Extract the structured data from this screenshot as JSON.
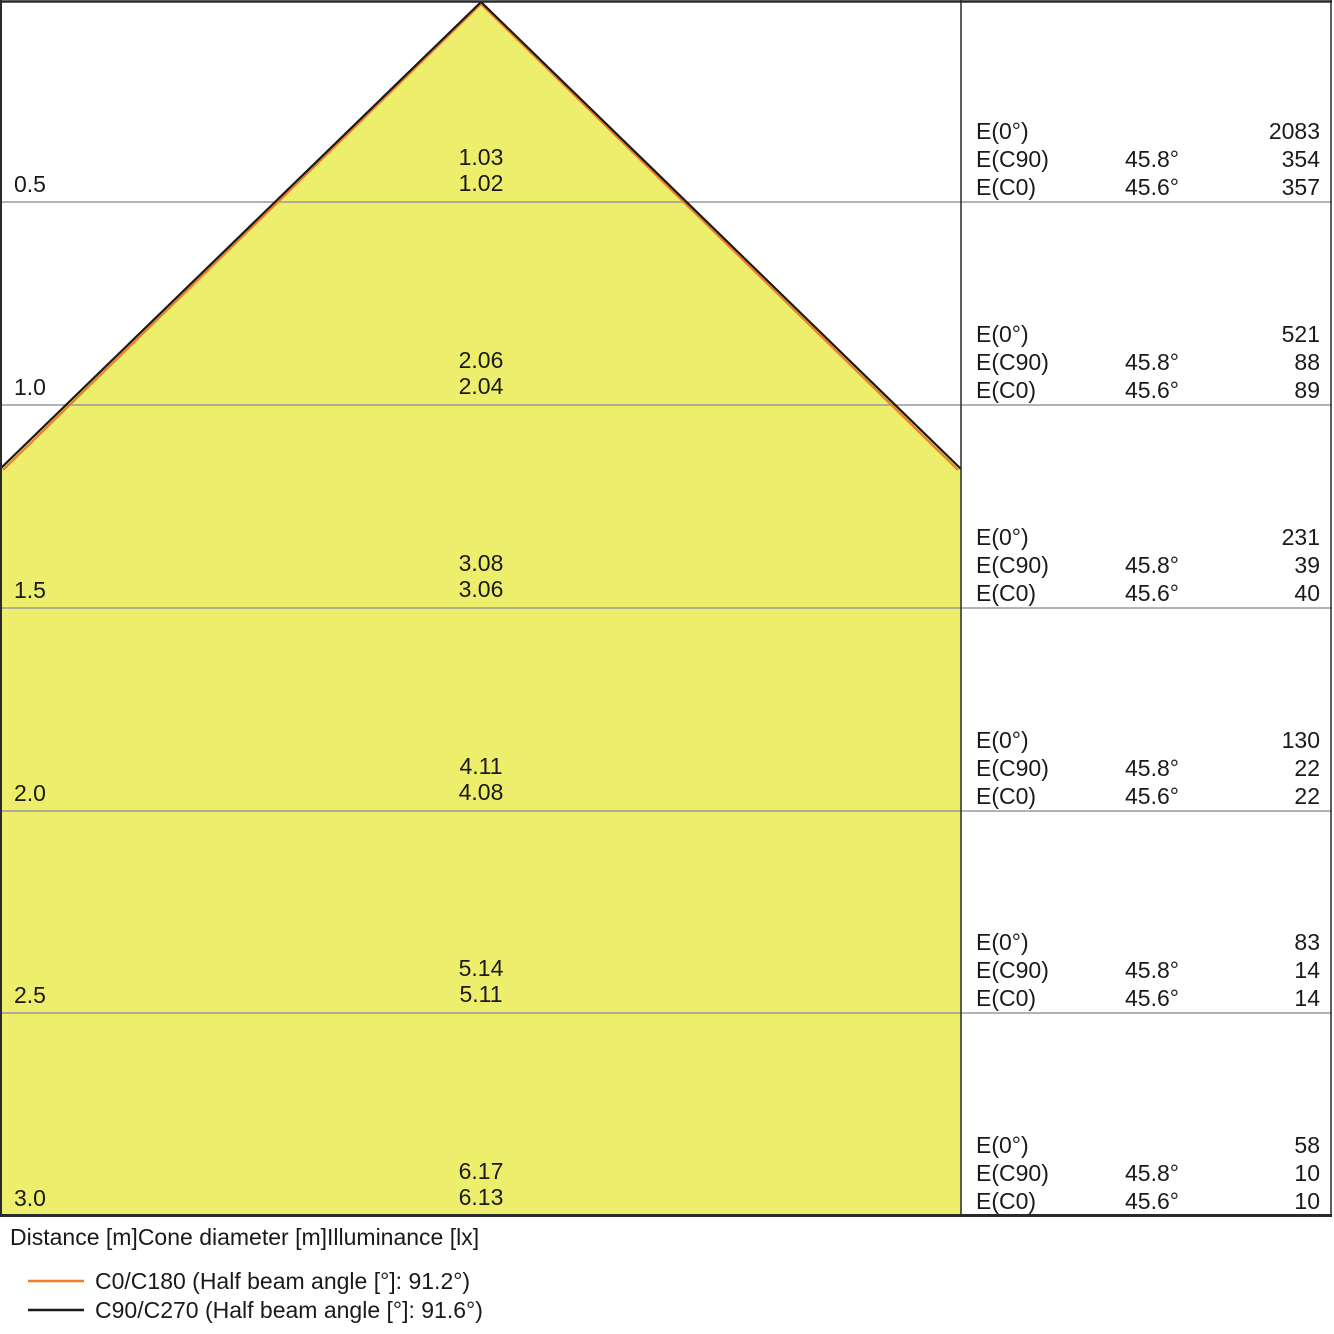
{
  "caption": "Distance [m]Cone diameter [m]Illuminance [lx]",
  "colors": {
    "cone_fill": "#edee6b",
    "c0_line": "#ef7d28",
    "c90_line": "#1a1a1a",
    "grid_line": "#9a9a9a",
    "border": "#2a2a2a"
  },
  "legend": {
    "c0": {
      "label": "C0/C180 (Half beam angle [°]: 91.2°)"
    },
    "c90": {
      "label": "C90/C270 (Half beam angle [°]: 91.6°)"
    }
  },
  "rows": [
    {
      "distance": "0.5",
      "dia_c90": "1.03",
      "dia_c0": "1.02",
      "e0_label": "E(0°)",
      "e0": "2083",
      "ec90_label": "E(C90)",
      "ec90_angle": "45.8°",
      "ec90": "354",
      "ec0_label": "E(C0)",
      "ec0_angle": "45.6°",
      "ec0": "357"
    },
    {
      "distance": "1.0",
      "dia_c90": "2.06",
      "dia_c0": "2.04",
      "e0_label": "E(0°)",
      "e0": "521",
      "ec90_label": "E(C90)",
      "ec90_angle": "45.8°",
      "ec90": "88",
      "ec0_label": "E(C0)",
      "ec0_angle": "45.6°",
      "ec0": "89"
    },
    {
      "distance": "1.5",
      "dia_c90": "3.08",
      "dia_c0": "3.06",
      "e0_label": "E(0°)",
      "e0": "231",
      "ec90_label": "E(C90)",
      "ec90_angle": "45.8°",
      "ec90": "39",
      "ec0_label": "E(C0)",
      "ec0_angle": "45.6°",
      "ec0": "40"
    },
    {
      "distance": "2.0",
      "dia_c90": "4.11",
      "dia_c0": "4.08",
      "e0_label": "E(0°)",
      "e0": "130",
      "ec90_label": "E(C90)",
      "ec90_angle": "45.8°",
      "ec90": "22",
      "ec0_label": "E(C0)",
      "ec0_angle": "45.6°",
      "ec0": "22"
    },
    {
      "distance": "2.5",
      "dia_c90": "5.14",
      "dia_c0": "5.11",
      "e0_label": "E(0°)",
      "e0": "83",
      "ec90_label": "E(C90)",
      "ec90_angle": "45.8°",
      "ec90": "14",
      "ec0_label": "E(C0)",
      "ec0_angle": "45.6°",
      "ec0": "14"
    },
    {
      "distance": "3.0",
      "dia_c90": "6.17",
      "dia_c0": "6.13",
      "e0_label": "E(0°)",
      "e0": "58",
      "ec90_label": "E(C90)",
      "ec90_angle": "45.8°",
      "ec90": "10",
      "ec0_label": "E(C0)",
      "ec0_angle": "45.6°",
      "ec0": "10"
    }
  ],
  "chart_data": {
    "type": "area",
    "title": "Luminous cone diagram (distance vs. cone diameter vs. illuminance)",
    "xlabel": "Cone diameter [m]",
    "ylabel": "Distance [m]",
    "categories": [
      0.5,
      1.0,
      1.5,
      2.0,
      2.5,
      3.0
    ],
    "series": [
      {
        "name": "C0/C180",
        "half_beam_angle_deg": 91.2,
        "half_angle_deg": 45.6,
        "cone_diameter_m": [
          1.02,
          2.04,
          3.06,
          4.08,
          5.11,
          6.13
        ],
        "illuminance_lx": [
          357,
          89,
          40,
          22,
          14,
          10
        ],
        "color": "#ef7d28"
      },
      {
        "name": "C90/C270",
        "half_beam_angle_deg": 91.6,
        "half_angle_deg": 45.8,
        "cone_diameter_m": [
          1.03,
          2.06,
          3.08,
          4.11,
          5.14,
          6.17
        ],
        "illuminance_lx": [
          354,
          88,
          39,
          22,
          14,
          10
        ],
        "color": "#1a1a1a"
      },
      {
        "name": "E(0°)",
        "illuminance_lx": [
          2083,
          521,
          231,
          130,
          83,
          58
        ]
      }
    ],
    "legend_position": "bottom-left",
    "grid": true
  }
}
